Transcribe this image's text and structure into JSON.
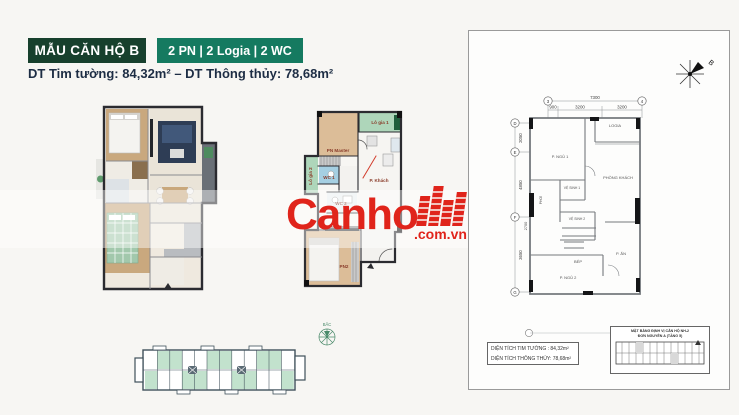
{
  "header": {
    "badge1": "MẪU CĂN HỘ B",
    "badge2": "2 PN | 2 Logia | 2 WC",
    "area": {
      "label1": "DT Tim tường:",
      "value1": "84,32m²",
      "dash": "–",
      "label2": "DT Thông thủy:",
      "value2": "78,68m²"
    }
  },
  "colors": {
    "badge1_bg": "#17402d",
    "badge2_bg": "#157a60",
    "watermark_red": "#e0241b",
    "logia_green": "#aed6ba",
    "wc_blue": "#a5cfe2",
    "room_tan": "#dcbd98",
    "floorplate_green": "#c2e2cd"
  },
  "plan2d": {
    "labels": {
      "lo_gia_1": "Lô gia 1",
      "pn_master": "PN Master",
      "wc1": "WC 1",
      "lo_gia_2": "Lô gia 2",
      "p_khach": "P. Khách",
      "wc2": "WC 2",
      "pn2": "PN2"
    }
  },
  "watermark": {
    "brand": "Canho",
    "suffix": ".com.vn"
  },
  "tech_plan": {
    "compass_label": "B",
    "grid_top": [
      "3",
      "4"
    ],
    "grid_left": [
      "D",
      "E",
      "F",
      "G"
    ],
    "dims": {
      "top_overall": "7300",
      "top_segments": [
        "900",
        "3200",
        "3200"
      ],
      "left": [
        "2050",
        "4850",
        "3650"
      ],
      "left_offset": "2700"
    },
    "rooms": {
      "logia": "LOGIA",
      "ngu1": "P. NGỦ 1",
      "khach": "PHÒNG KHÁCH",
      "vs1": "VỆ SINH 1",
      "vs2": "VỆ SINH 2",
      "phoi": "PHƠI",
      "bep": "BẾP",
      "an": "P. ĂN",
      "ngu2": "P. NGỦ 2"
    },
    "area_table": [
      {
        "label": "DIỆN TÍCH TIM TƯỜNG :",
        "value": "84,32m²"
      },
      {
        "label": "DIỆN TÍCH THÔNG THỦY:",
        "value": "78,68m²"
      }
    ],
    "keyplan": {
      "line1": "MẶT BẰNG ĐỊNH VỊ CĂN HỘ NH-2",
      "line2": "ĐƠN NGUYÊN A (TẦNG 5)"
    }
  },
  "floorplate": {
    "compass_label": "BẮC"
  }
}
